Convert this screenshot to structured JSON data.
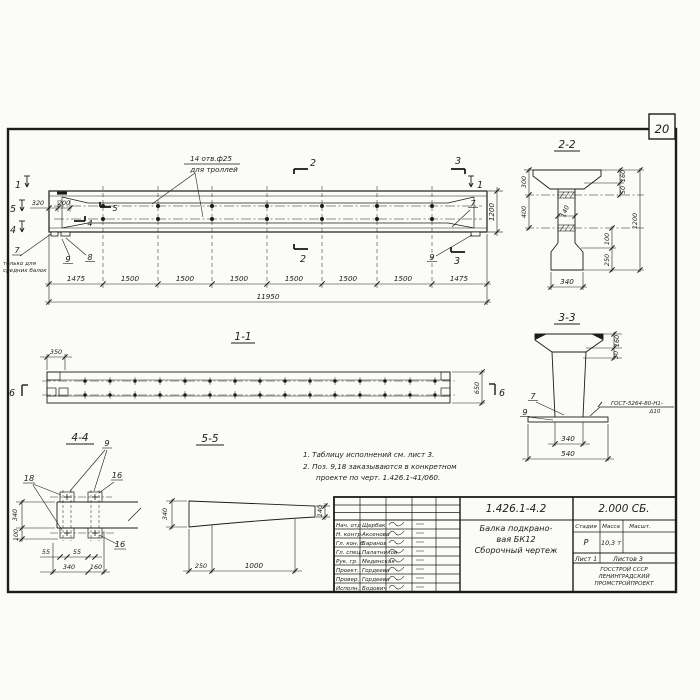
{
  "page": {
    "number": "20"
  },
  "main": {
    "hole_note1": "14 отв.ф25",
    "hole_note2": "для троллей",
    "dim_320": "320",
    "dim_200": "200",
    "dim_1200": "1200",
    "segments": [
      "1475",
      "1500",
      "1500",
      "1500",
      "1500",
      "1500",
      "1500",
      "1475"
    ],
    "total": "11950",
    "cut1": "1",
    "cut2": "2",
    "cut3": "3",
    "cut4": "4",
    "cut5": "5",
    "callout7_left": "7",
    "support_note1": "только для",
    "support_note2": "средних балок",
    "callout9_left": "9",
    "callout8": "8",
    "callout9_right": "9",
    "callout7_right": "7"
  },
  "s11": {
    "label": "1-1",
    "d350": "350",
    "d650": "650",
    "m6": "6"
  },
  "s22": {
    "label": "2-2",
    "d300": "300",
    "d400": "400",
    "d160": "160",
    "d50": "50",
    "d140": "140",
    "d1200": "1200",
    "d100": "100",
    "d250": "250",
    "d340": "340"
  },
  "s33": {
    "label": "3-3",
    "d160": "160",
    "d30": "30",
    "d340": "340",
    "d540": "540",
    "c7": "7",
    "c9": "9",
    "weld1": "ГОСТ-5264-80-Н1-",
    "weld2": "Δ10"
  },
  "v44": {
    "label": "4-4",
    "c9": "9",
    "c18": "18",
    "c16a": "16",
    "c16b": "16",
    "d340v": "340",
    "d100": "100",
    "d55a": "55",
    "d55b": "55",
    "d340b": "340",
    "d160": "160"
  },
  "v55": {
    "label": "5-5",
    "d340": "340",
    "d140": "140",
    "d250": "250",
    "d1000": "1000"
  },
  "notes": {
    "line1": "1. Таблицу исполнений см. лист 3.",
    "line2": "2. Поз. 9,18 заказываются в конкретном",
    "line3": "проекте по черт. 1.426.1-41/060."
  },
  "title_block": {
    "doc_number": "1.426.1-4.2",
    "series": "2.000 СБ.",
    "title_line1": "Балка подкрано-",
    "title_line2": "вая БК12",
    "title_line3": "Сборочный чертеж",
    "stage_label": "Стадия",
    "mass_label": "Масса",
    "scale_label": "Масшт.",
    "stage_value": "Р",
    "mass_value": "10,3 т",
    "sheet_label": "Лист 1",
    "sheets_label": "Листов 3",
    "org_line1": "ГОССТРОЙ СССР",
    "org_line2": "ЛЕНИНГРАДСКИЙ",
    "org_line3": "ПРОМСТРОЙПРОЕКТ",
    "signature_rows": [
      {
        "role": "Нач. отд",
        "name": "Щербак"
      },
      {
        "role": "Н. контр.",
        "name": "Аксенова"
      },
      {
        "role": "Гл. кон. б",
        "name": "Баранов"
      },
      {
        "role": "Гл. спец.",
        "name": "Палатников"
      },
      {
        "role": "Рук. гр.",
        "name": "Мединская"
      },
      {
        "role": "Проект.",
        "name": "Гордеева"
      },
      {
        "role": "Провер.",
        "name": "Гордеева"
      },
      {
        "role": "Исполн.",
        "name": "Бодович"
      }
    ]
  }
}
